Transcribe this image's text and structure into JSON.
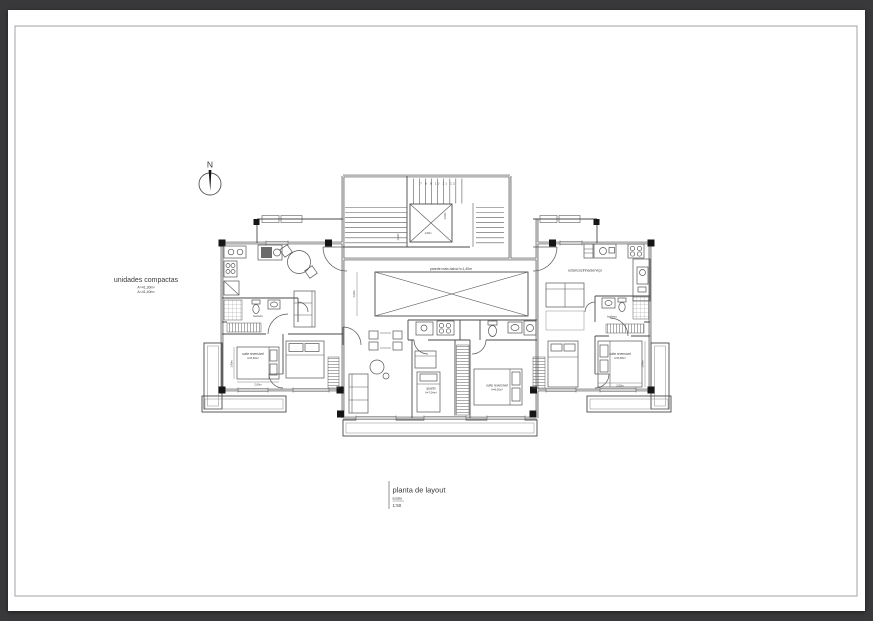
{
  "sheet": {
    "background_color": "#39393b",
    "paper_color": "#ffffff",
    "line_color": "#3d3d3d"
  },
  "north_arrow": {
    "label": "N"
  },
  "side_note": {
    "title": "unidades compactas",
    "area_line1": "A=41,30m²",
    "area_line2": "A=41,40m²"
  },
  "plan": {
    "core": {
      "stair_numbers": "7 8 9 10 11 12",
      "dim_shaft_w": "1,60m",
      "dim_shaft_h": "1,50m",
      "dim_flight": "1,00m"
    },
    "center_unit": {
      "parede_label": "parede mais baixa h=1,40m",
      "quarto_name": "quarto",
      "quarto_area": "A=7,04m²",
      "suite_name": "suíte reversível",
      "suite_area": "A=8,05m²",
      "dim_void": "1,20m"
    },
    "left_unit": {
      "suite_name": "suíte reversível",
      "suite_area": "A=8,36m²",
      "bath_label": "banheiro",
      "dim_w": "2,60m",
      "dim_h": "1,40m"
    },
    "right_unit": {
      "estar_label": "estar/cozinha/serviço",
      "suite_name": "suíte reversível",
      "suite_area": "A=8,08m²",
      "bath_label": "banheiro",
      "dim_w": "2,60m",
      "dim_h": "1,40m"
    }
  },
  "title_block": {
    "title": "planta de layout",
    "scale_label": "escala",
    "scale_value": "1:50"
  }
}
